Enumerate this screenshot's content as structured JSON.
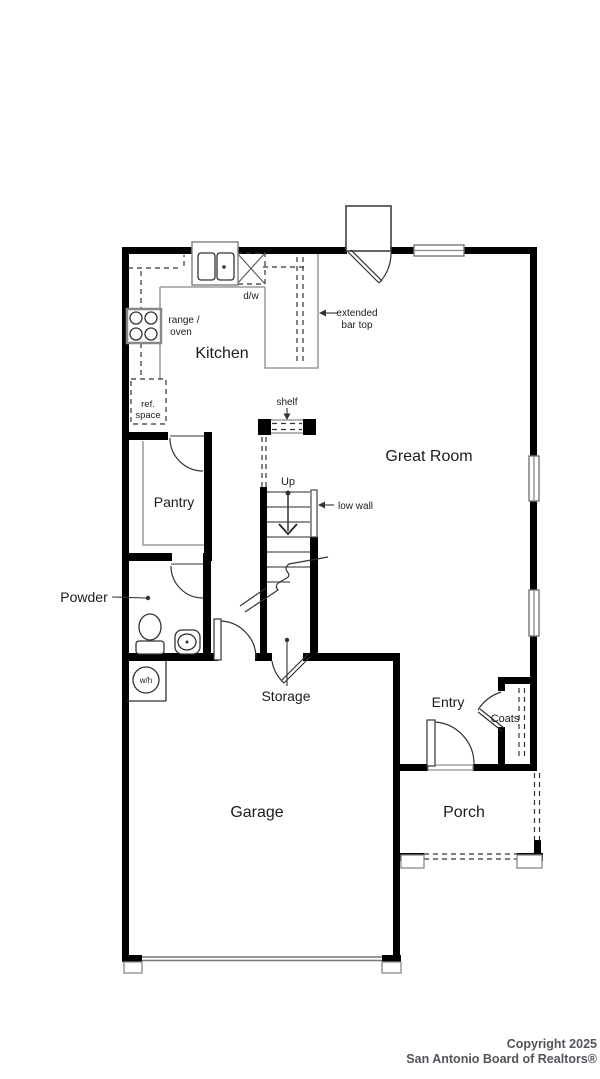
{
  "plan": {
    "labels": {
      "kitchen": "Kitchen",
      "great_room": "Great Room",
      "pantry": "Pantry",
      "powder": "Powder",
      "storage": "Storage",
      "entry": "Entry",
      "coats": "Coats",
      "porch": "Porch",
      "garage": "Garage"
    },
    "annotations": {
      "dw": "d/w",
      "range_oven_1": "range /",
      "range_oven_2": "oven",
      "ref_space_1": "ref.",
      "ref_space_2": "space",
      "extended_bar_1": "extended",
      "extended_bar_2": "bar top",
      "shelf": "shelf",
      "up": "Up",
      "low_wall": "low wall",
      "water_heater": "w/h"
    },
    "colors": {
      "walls": "#000000",
      "thin_lines": "#888888",
      "label_text": "#1c1c1c"
    }
  },
  "footer": {
    "line1": "Copyright 2025",
    "line2": "San Antonio Board of Realtors®",
    "color": "#54555b"
  }
}
